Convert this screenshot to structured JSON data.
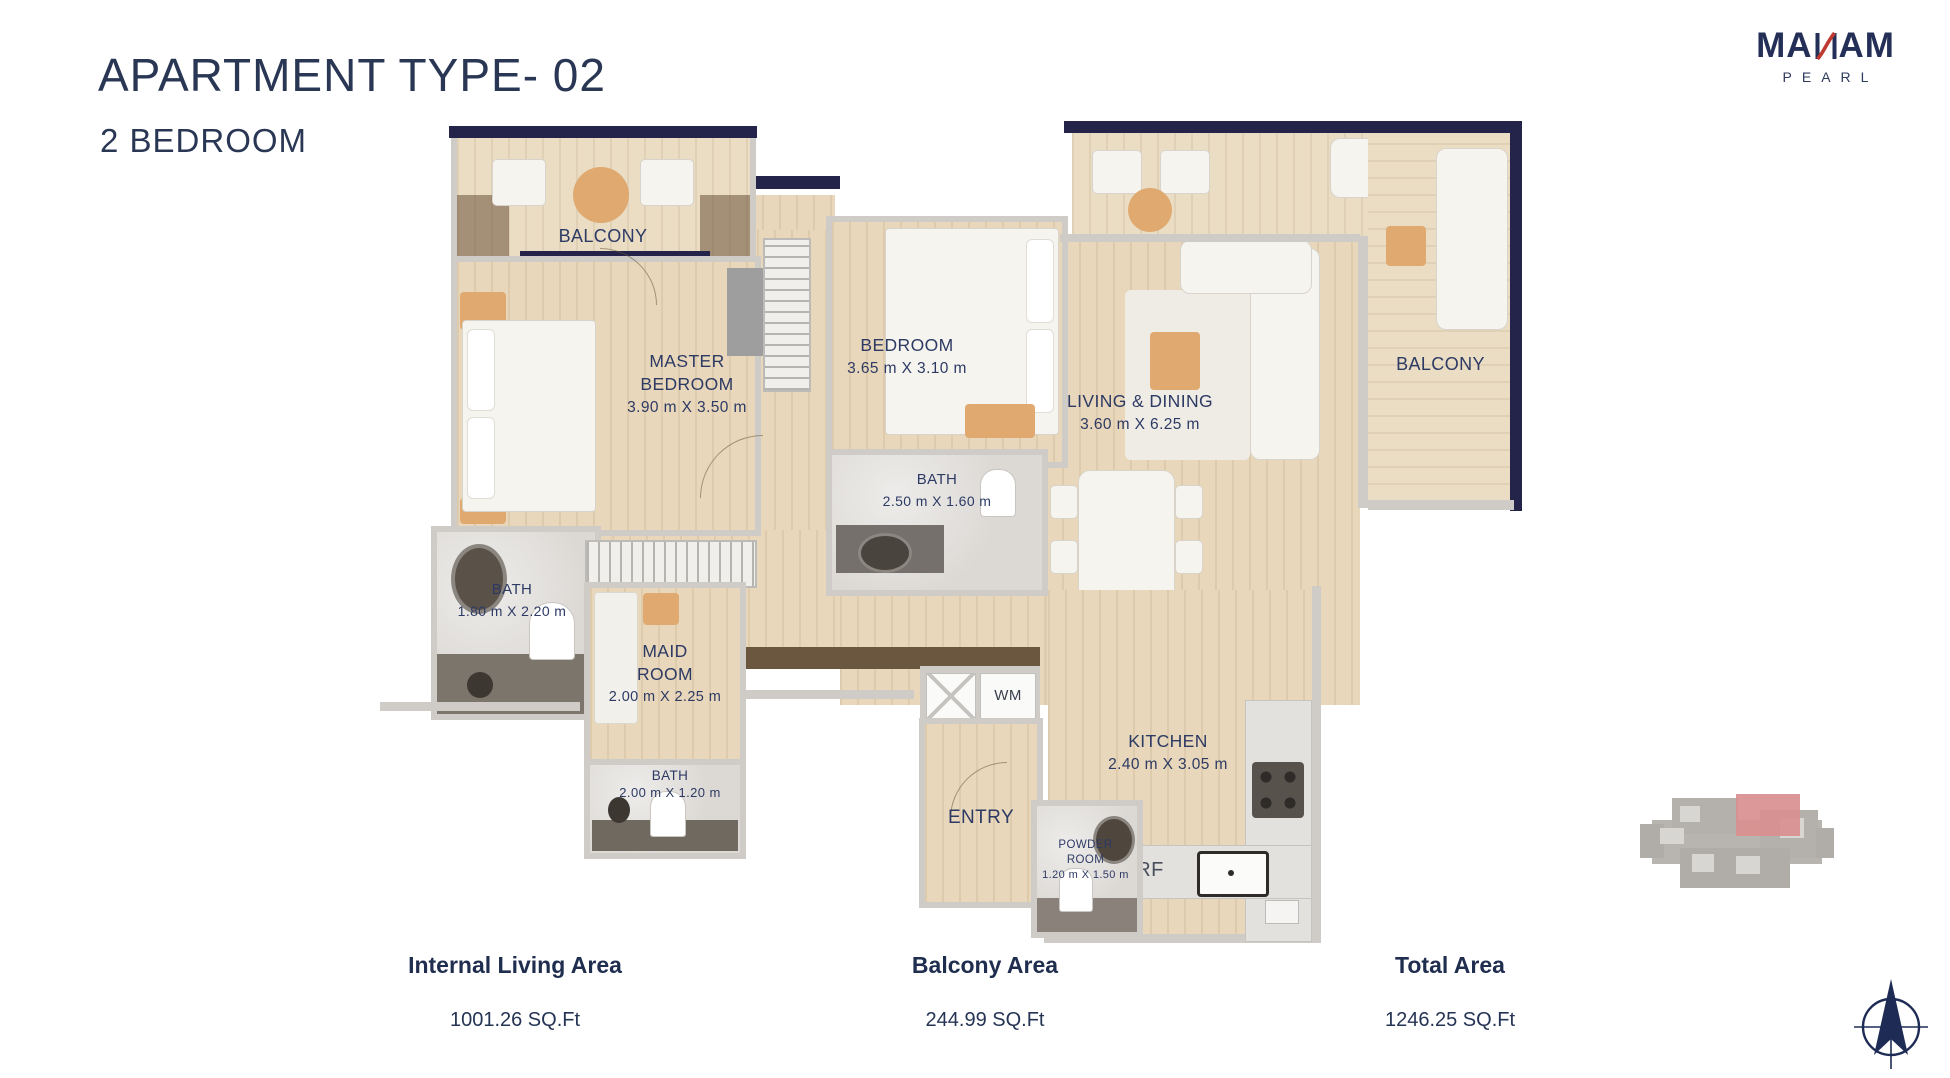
{
  "header": {
    "title": "APARTMENT TYPE- 02",
    "subtitle": "2 BEDROOM"
  },
  "logo": {
    "wordmark_prefix": "MA",
    "wordmark_reversed_n": "И",
    "wordmark_suffix": "AM",
    "subtitle": "PEARL"
  },
  "floorplan": {
    "rooms": {
      "balcony_left": {
        "name": "BALCONY"
      },
      "master_bedroom": {
        "name": "MASTER BEDROOM",
        "dims": "3.90 m X 3.50 m"
      },
      "bedroom": {
        "name": "BEDROOM",
        "dims": "3.65 m X 3.10 m"
      },
      "living_dining": {
        "name": "LIVING & DINING",
        "dims": "3.60 m X 6.25 m"
      },
      "balcony_right": {
        "name": "BALCONY"
      },
      "bath_master": {
        "name": "BATH",
        "dims": "1.80 m X 2.20 m"
      },
      "bath_bedroom": {
        "name": "BATH",
        "dims": "2.50 m X 1.60 m"
      },
      "maid_room": {
        "name": "MAID ROOM",
        "dims": "2.00 m X 2.25 m"
      },
      "bath_maid": {
        "name": "BATH",
        "dims": "2.00 m X 1.20 m"
      },
      "kitchen": {
        "name": "KITCHEN",
        "dims": "2.40 m X 3.05 m"
      },
      "entry": {
        "name": "ENTRY"
      },
      "powder_room": {
        "name": "POWDER ROOM",
        "dims": "1.20 m X 1.50 m"
      },
      "wm": {
        "name": "WM"
      },
      "rf": {
        "name": "RF"
      }
    }
  },
  "areas": [
    {
      "label": "Internal Living Area",
      "value": "1001.26 SQ.Ft"
    },
    {
      "label": "Balcony Area",
      "value": "244.99 SQ.Ft"
    },
    {
      "label": "Total Area",
      "value": "1246.25 SQ.Ft"
    }
  ],
  "colors": {
    "brand_navy": "#232f56",
    "brand_red": "#bf3a31",
    "label_navy": "#2d3a64",
    "outer_wall_navy": "#24244b",
    "wall_gray": "#cfccc8",
    "wood_floor": "#e8d7ba",
    "key_plan_highlight": "#d98f8f"
  }
}
